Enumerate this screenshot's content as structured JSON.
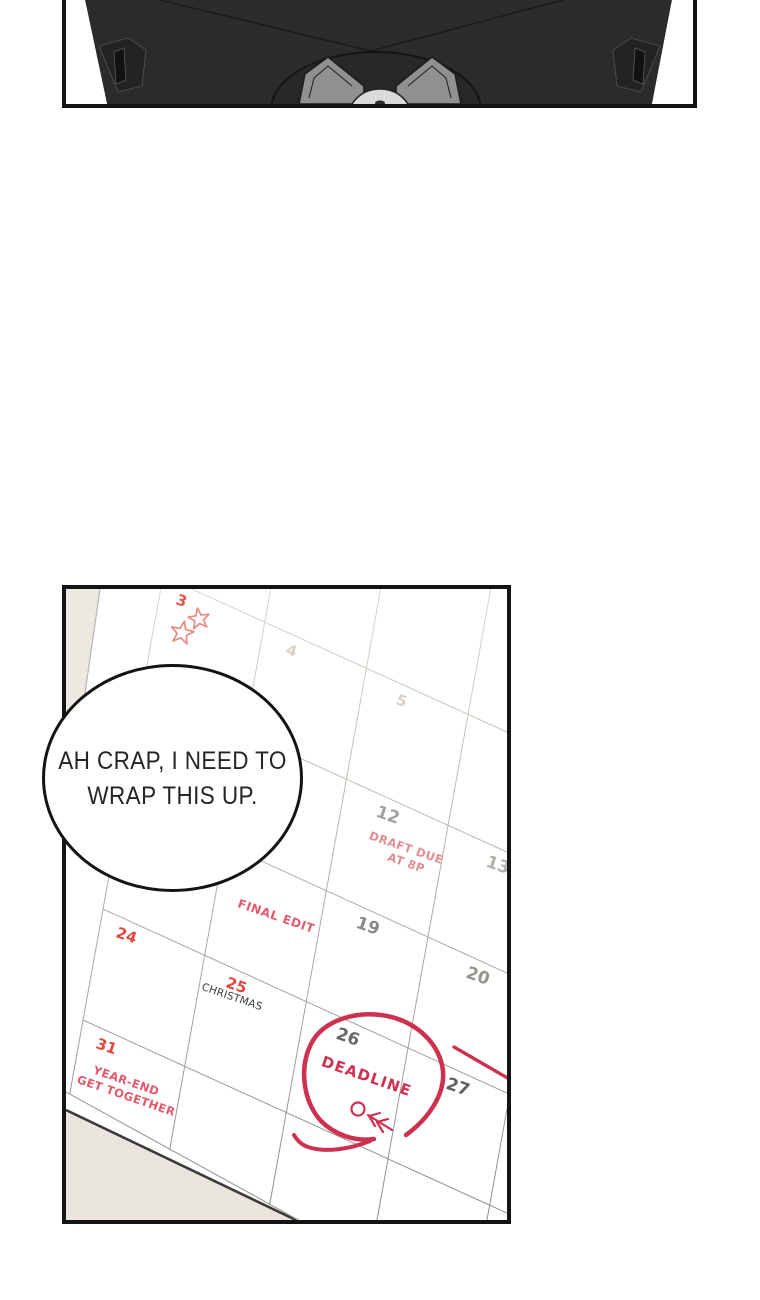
{
  "page_type": "comic-page",
  "speech_bubble": {
    "lines": [
      "AH CRAP, I NEED TO",
      "WRAP THIS UP."
    ]
  },
  "calendar": {
    "days": [
      {
        "label": "3",
        "col": 0,
        "row": 0,
        "color": "#e0544a",
        "size": 15
      },
      {
        "label": "4",
        "col": 1,
        "row": 0,
        "color": "#d9d3c6",
        "size": 15
      },
      {
        "label": "5",
        "col": 2,
        "row": 0,
        "color": "#d9d3c6",
        "size": 15
      },
      {
        "label": "12",
        "col": 2,
        "row": 1,
        "color": "#a3a19c",
        "size": 17
      },
      {
        "label": "13",
        "col": 3,
        "row": 1,
        "color": "#b2b0ab",
        "size": 17
      },
      {
        "label": "19",
        "col": 2,
        "row": 2,
        "color": "#8b8985",
        "size": 17
      },
      {
        "label": "20",
        "col": 3,
        "row": 2,
        "color": "#96948f",
        "size": 17
      },
      {
        "label": "24",
        "col": 0,
        "row": 3,
        "color": "#e2473d",
        "size": 15
      },
      {
        "label": "25",
        "col": 1,
        "row": 3,
        "color": "#e2473d",
        "size": 15
      },
      {
        "label": "26",
        "col": 2,
        "row": 3,
        "color": "#6b6966",
        "size": 17
      },
      {
        "label": "27",
        "col": 3,
        "row": 3,
        "color": "#605e5b",
        "size": 17
      },
      {
        "label": "31",
        "col": 0,
        "row": 4,
        "color": "#e2473d",
        "size": 15
      }
    ],
    "notes": [
      {
        "lines": [
          "DRAFT DUE",
          "AT 8P"
        ],
        "col": 2,
        "row": 1,
        "color": "#e28d96",
        "placement": "center",
        "size": 11.5,
        "weight": "bold",
        "spacing": 0.4
      },
      {
        "lines": [
          "FINAL EDIT"
        ],
        "col": 1,
        "row": 2,
        "color": "#e05a6b",
        "placement": "center",
        "size": 12,
        "weight": "bold",
        "spacing": 0.6
      },
      {
        "lines": [
          "CHRISTMAS"
        ],
        "col": 1,
        "row": 3,
        "color": "#3c3b39",
        "placement": "under-day",
        "size": 10.5,
        "weight": "normal",
        "spacing": 0.2
      },
      {
        "lines": [
          "YEAR-END",
          "GET TOGETHER"
        ],
        "col": 0,
        "row": 4,
        "color": "#e05a6b",
        "placement": "center",
        "size": 11.5,
        "weight": "bold",
        "spacing": 0.4
      },
      {
        "lines": [
          "DEADLINE"
        ],
        "col": 2,
        "row": 3,
        "color": "#ce3150",
        "placement": "center",
        "size": 15,
        "weight": "bold",
        "spacing": 1.2
      }
    ]
  },
  "colors": {
    "panel_border": "#141414",
    "paper": "#ffffff",
    "desk": "#e9e5de",
    "machine_body": "#2b2b2b",
    "machine_blade": "#909090",
    "machine_hub": "#dadada",
    "marker_red": "#ce3150",
    "star_red": "#ea8a80",
    "grid_faint": "#dbd6cb",
    "grid_dark": "#8f8d88"
  }
}
